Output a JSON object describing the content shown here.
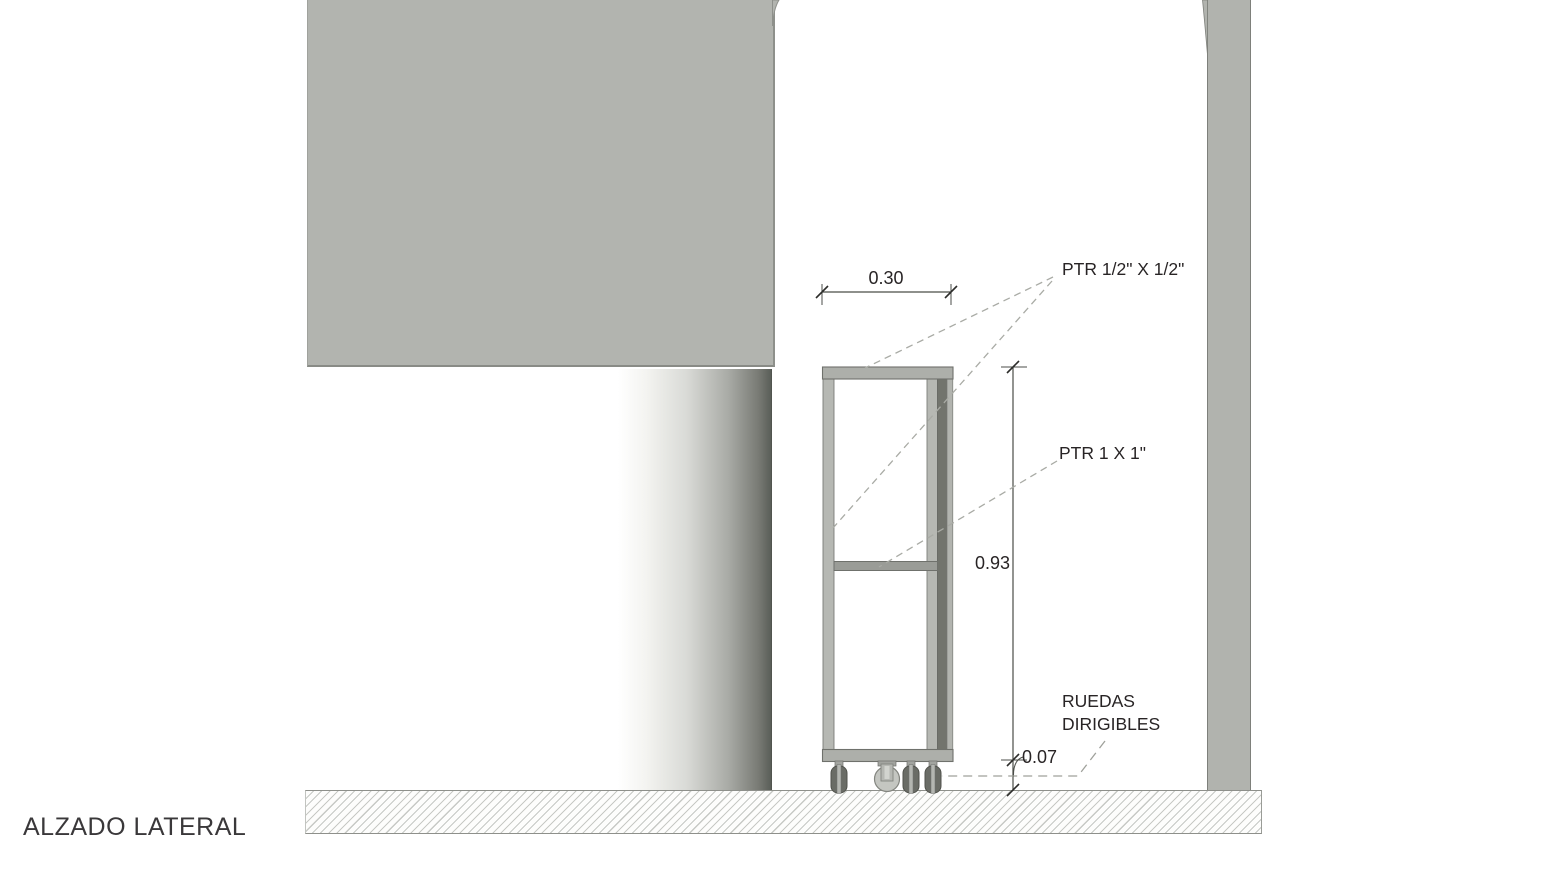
{
  "view": {
    "title": "ALZADO LATERAL"
  },
  "dimensions": {
    "width_m": "0.30",
    "height_m": "0.93",
    "caster_height_m": "0.07"
  },
  "annotations": {
    "frame_small_profile": "PTR 1/2\" X 1/2\"",
    "frame_large_profile": "PTR 1 X 1\"",
    "casters_line1": "RUEDAS",
    "casters_line2": "DIRIGIBLES"
  },
  "colors": {
    "wall_gray": "#b2b4af",
    "outline_gray": "#8e908b",
    "frame_light_gray": "#b6b8b3",
    "frame_dark_gray": "#72746d",
    "ink": "#282425",
    "leader_gray": "#a9aba5"
  }
}
